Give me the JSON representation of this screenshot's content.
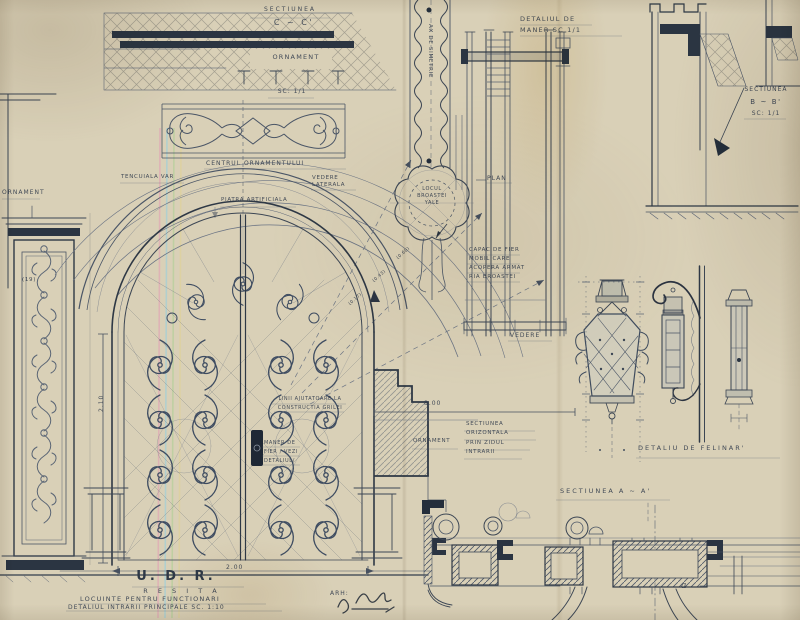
{
  "colors": {
    "paper": "#d9d0b7",
    "ink": "#3c4654",
    "dark_ink": "#242e3b",
    "pencil": "#6b7484",
    "stripe_pink": "#e39cb5",
    "stripe_blue": "#92cfe2",
    "stripe_green": "#abcf92",
    "stripe_yellow": "#e2d392"
  },
  "top_left": {
    "section_title": "SECTIUNEA",
    "section_sub": "C ~ C'",
    "ornament": "ORNAMENT",
    "scale": "SC: 1/1",
    "centrul": "CENTRUL ORNAMENTULUI",
    "tencuiala": "TENCUIALA VAR",
    "vedere_laterala": "VEDERE\nLATERALA",
    "piatra": "PIATRA ARTIFICIALA"
  },
  "left_edge": {
    "ornament": "ORNAMENT",
    "note": "(19)"
  },
  "handle": {
    "title": "DETALIUL DE\nMANER      SC 1/1",
    "capac": "CAPAC DE FIER\nMOBIL CARE\nACOPERA ARMAT\nRIA BROASTEI",
    "vedere": "VEDERE",
    "ax": "AX DE SIMETRIE",
    "lock": "LOCUL\nBROASTEI\nYALE",
    "plan": "PLAN"
  },
  "section_bb": {
    "title": "SECTIUNEA",
    "sub": "B ~ B'",
    "scale": "SC: 1/1"
  },
  "door": {
    "linii": "LINII AJUTATOARE LA\nCONSTRUCTIA GRILEI",
    "maner": "MANER DE\nFIER / VEZI\nDETALIUL/",
    "dim_height": "2.10",
    "dim_width": "2.00",
    "radial_dims": [
      "(0.17)",
      "(0.43)",
      "(0.60)"
    ]
  },
  "wall_section": {
    "dim": "8.00",
    "ornament": "ORNAMENT",
    "title": "SECTIUNEA\nORIZONTALA\nPRIN ZIDUL\nINTRARII"
  },
  "felinar": {
    "title": "DETALIU  DE  FELINAR'"
  },
  "section_aa": {
    "title": "SECTIUNEA    A ~ A'",
    "letter_a": "a"
  },
  "title_block": {
    "udr": "U. D. R.",
    "resita": "R E S I T A",
    "line1": "LOCUINTE  PENTRU  FUNCTIONARI",
    "line2": "DETALIUL  INTRARII  PRINCIPALE   SC. 1:10",
    "arh": "ARH:"
  }
}
